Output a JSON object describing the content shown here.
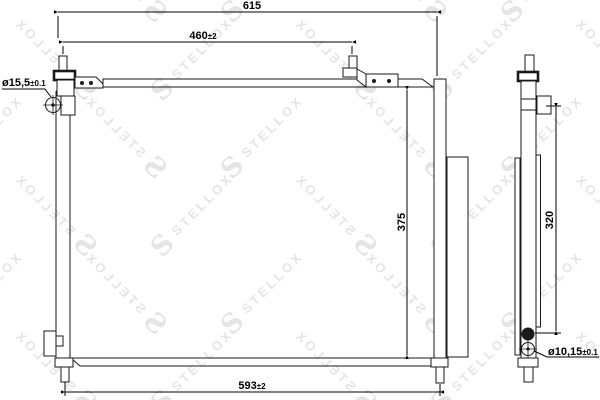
{
  "drawing": {
    "watermark": {
      "logo": "S",
      "brand": "STELLOX"
    },
    "dimensions": {
      "overall_width": {
        "value": "615",
        "tol": ""
      },
      "mount_span_top": {
        "value": "460",
        "tol": "±2"
      },
      "inlet_port_diameter": {
        "value": "ø15,5",
        "tol": "±0.1"
      },
      "core_height": {
        "value": "375",
        "tol": ""
      },
      "receiver_drier_height": {
        "value": "320",
        "tol": ""
      },
      "outlet_port_diameter": {
        "value": "ø10,15",
        "tol": "±0.1"
      },
      "mount_span_bottom": {
        "value": "593",
        "tol": "±2"
      }
    }
  }
}
